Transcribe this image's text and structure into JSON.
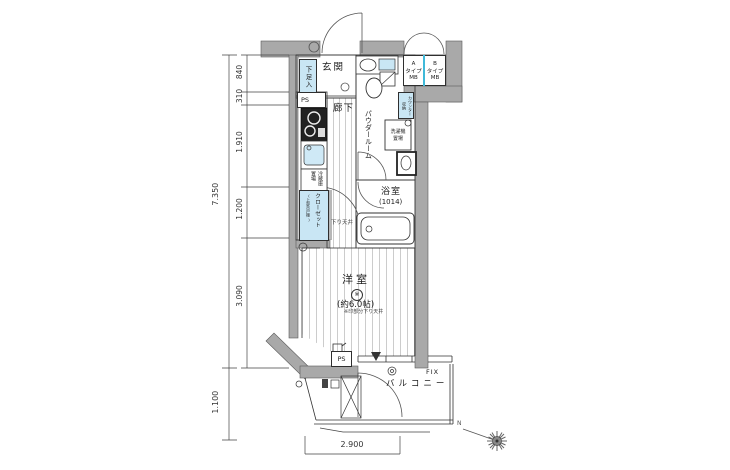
{
  "plan": {
    "rooms": {
      "genkan": "玄関",
      "corridor": "廊下",
      "powder_room": "パウダールーム",
      "bathroom": "浴室",
      "bathroom_size": "(1014)",
      "western_room": "洋室",
      "western_room_mark": "※",
      "western_room_size": "(約6.0帖)",
      "balcony": "バルコニー"
    },
    "storage": {
      "shoe_box": "下足入",
      "refrigerator_space": "冷蔵庫\n置場",
      "closet": "クローゼット",
      "closet_sub": "(上部吊戸棚)",
      "counter_storage": "カウンター\n収納",
      "washer_space": "洗濯機\n置場"
    },
    "labels": {
      "ps_top": "PS",
      "ps_bottom": "PS",
      "fix": "FIX",
      "mb_a": "A\nタイプ\nMB",
      "mb_b": "B\nタイプ\nMB",
      "lowered_ceiling": "下り天井",
      "room_note": "※印部分下り天井",
      "north": "N"
    },
    "dimensions": {
      "total_height": "7.350",
      "seg_840": "840",
      "seg_310": "310",
      "seg_1910": "1.910",
      "seg_1200": "1.200",
      "seg_3090": "3.090",
      "balcony_depth": "1.100",
      "width": "2.900"
    },
    "colors": {
      "wall": "#a9a9a9",
      "storage_blue": "#c9e6f4",
      "mb_divider": "#3fb9d9"
    }
  }
}
